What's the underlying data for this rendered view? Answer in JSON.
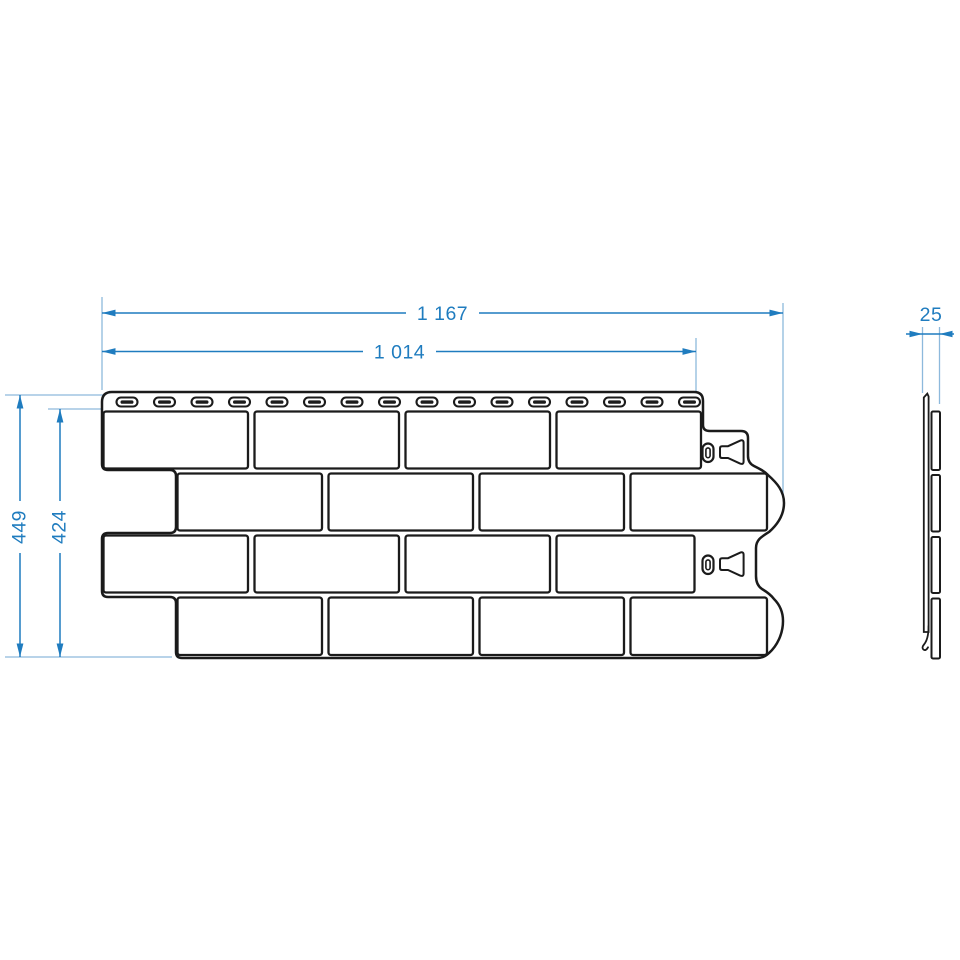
{
  "drawing": {
    "subject": "brick-facade-cladding-panel",
    "views": {
      "front": "panel front view with brick pattern, nailing strip and fastening slots",
      "side": "panel edge profile"
    }
  },
  "dimensions": {
    "overall_width": "1 167",
    "nominal_width": "1 014",
    "overall_height": "449",
    "nominal_height": "424",
    "thickness": "25"
  },
  "counts": {
    "nail_slots": 16,
    "brick_rows": 4,
    "bricks_per_row": 4,
    "keyhole_marks": 2
  },
  "colors": {
    "dimension_blue": "#1f7cbf",
    "extension_blue": "#8db9dc",
    "outline_black": "#1b1b1b",
    "fill_white": "#ffffff"
  }
}
